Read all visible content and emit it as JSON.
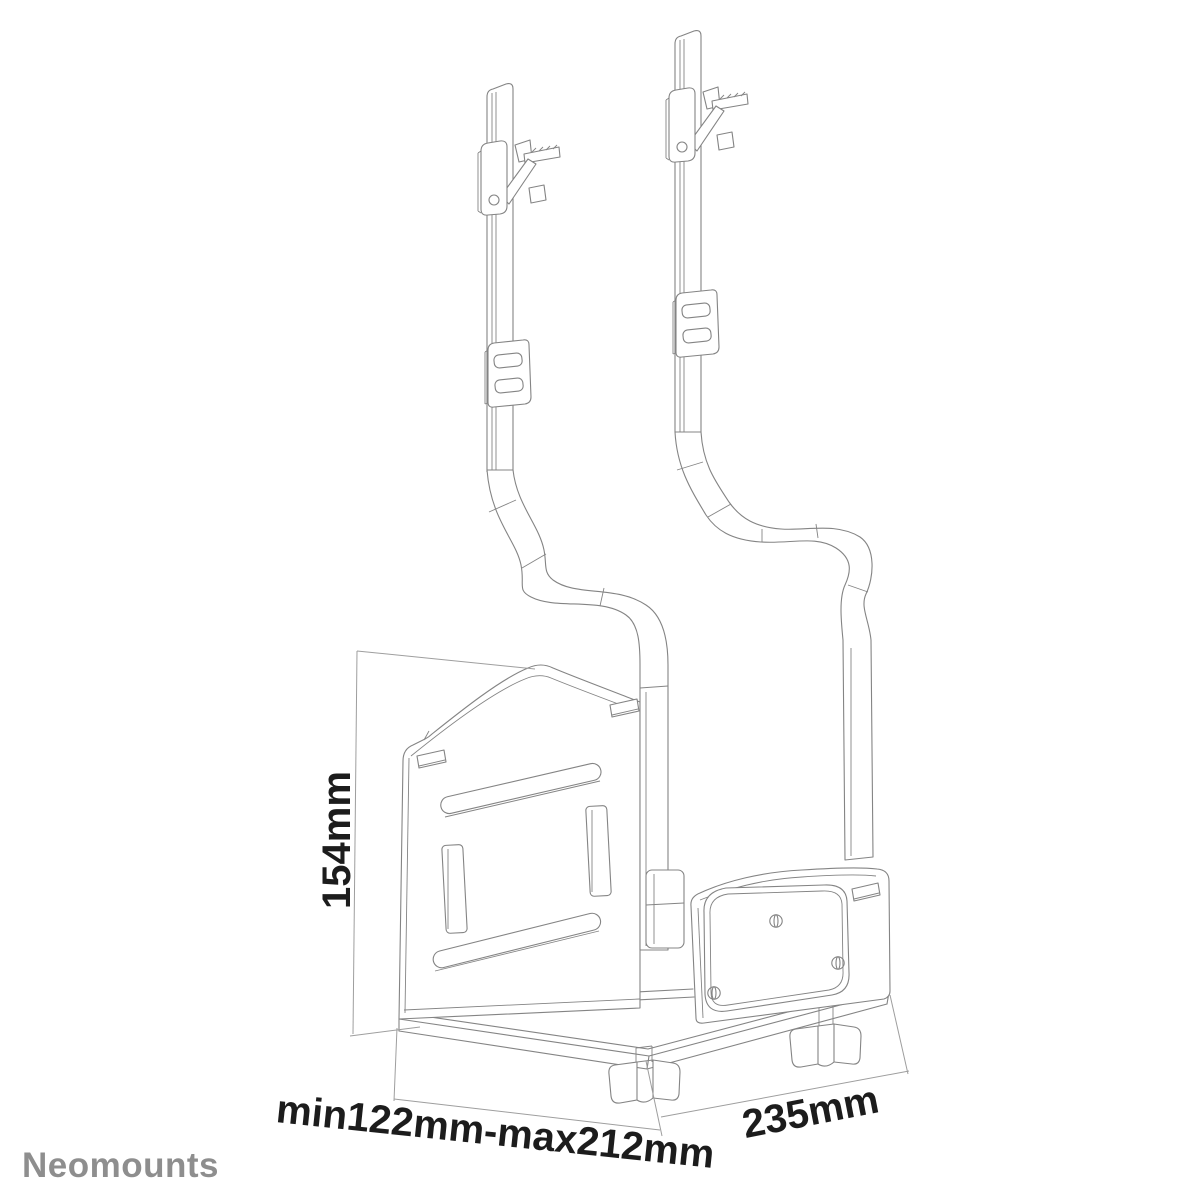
{
  "brand": {
    "logo": "Neomounts"
  },
  "colors": {
    "line": "#848484",
    "dimension": "#9e9e9e",
    "text": "#1c1c1c",
    "logo": "#8e8e8e",
    "background": "#ffffff"
  },
  "diagram": {
    "type": "technical-line-drawing",
    "parts": [
      "left-hanging-strap",
      "right-hanging-strap",
      "desk-hook",
      "strap-buckle",
      "holder-back-panel",
      "holder-base",
      "holder-clamp-panel",
      "wing-knob"
    ],
    "dimensions": {
      "height": "154mm",
      "width_range": "min122mm-max212mm",
      "depth": "235mm"
    }
  }
}
